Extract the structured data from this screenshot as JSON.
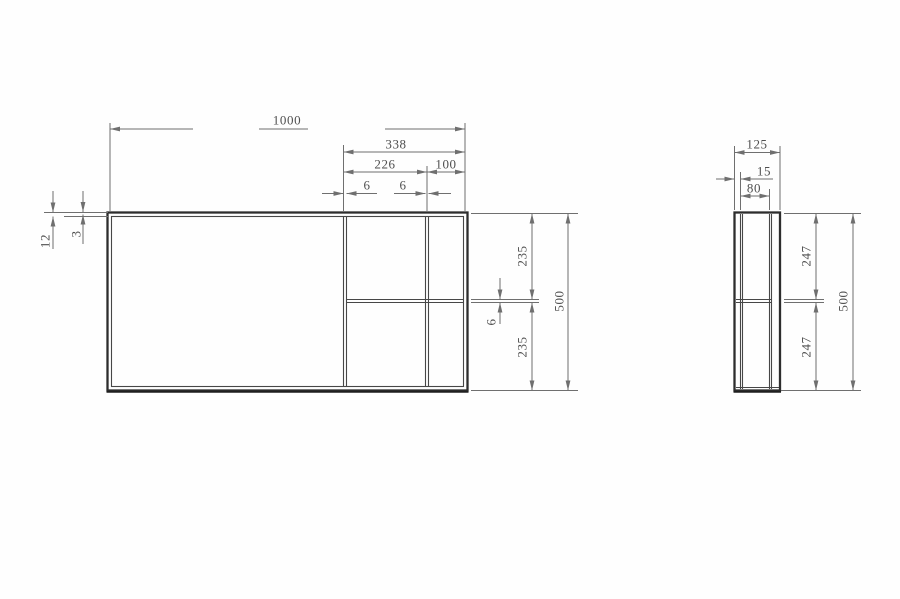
{
  "front_view": {
    "overall_width": "1000",
    "right_section_width": "338",
    "right_inner_width": "226",
    "right_end_width": "100",
    "divider_left_thickness": "6",
    "divider_right_thickness": "6",
    "top_panel_thickness": "12",
    "top_gap": "3",
    "upper_cell_height": "235",
    "shelf_thickness": "6",
    "lower_cell_height": "235",
    "overall_height": "500"
  },
  "side_view": {
    "overall_depth": "125",
    "front_panel_thickness": "15",
    "inner_depth": "80",
    "upper_height": "247",
    "lower_height": "247",
    "overall_height": "500"
  },
  "colors": {
    "outline": "#2d2d2d",
    "inner_line": "#474747",
    "dimension_line": "#6f6f6f",
    "dimension_text": "#4f4f4f",
    "background": "#fefefe"
  }
}
